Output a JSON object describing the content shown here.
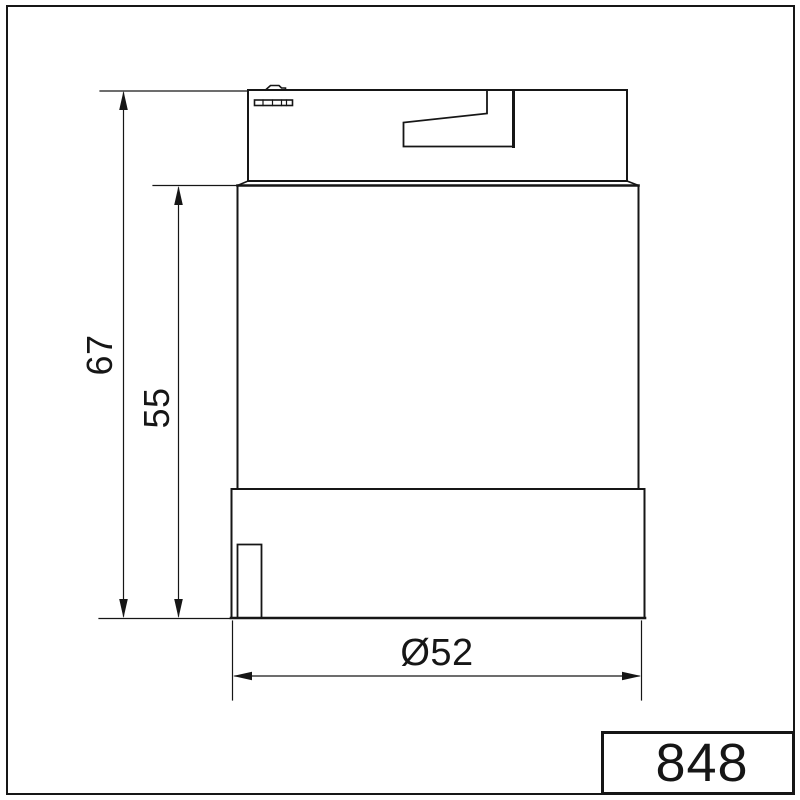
{
  "colors": {
    "line": "#161616",
    "background": "#ffffff"
  },
  "drawing": {
    "part_number": "848",
    "dimensions": {
      "overall_height": "67",
      "lens_height": "55",
      "diameter": "Ø52"
    }
  }
}
